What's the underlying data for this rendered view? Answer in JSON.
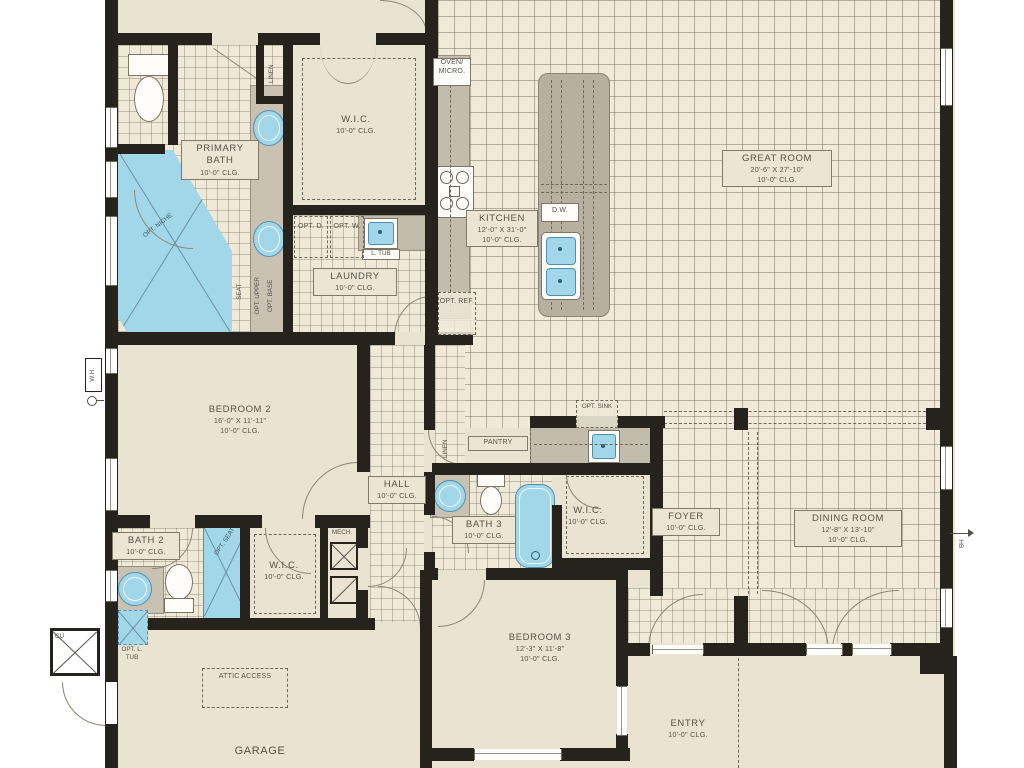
{
  "plan": {
    "rooms": {
      "primary_bath": {
        "name": "PRIMARY BATH",
        "clg": "10'-0\" CLG."
      },
      "wic_primary": {
        "name": "W.I.C.",
        "clg": "10'-0\" CLG."
      },
      "laundry": {
        "name": "LAUNDRY",
        "clg": "10'-0\" CLG."
      },
      "kitchen": {
        "name": "KITCHEN",
        "dims": "12'-0\" X 31'-0\"",
        "clg": "10'-0\" CLG."
      },
      "great_room": {
        "name": "GREAT ROOM",
        "dims": "20'-6\" X 27'-10\"",
        "clg": "10'-0\" CLG."
      },
      "bedroom2": {
        "name": "BEDROOM 2",
        "dims": "16'-0\" X 11'-11\"",
        "clg": "10'-0\" CLG."
      },
      "hall": {
        "name": "HALL",
        "clg": "10'-0\" CLG."
      },
      "bath2": {
        "name": "BATH 2",
        "clg": "10'-0\" CLG."
      },
      "wic_bedroom2": {
        "name": "W.I.C.",
        "clg": "10'-0\" CLG."
      },
      "bath3": {
        "name": "BATH 3",
        "clg": "10'-0\" CLG."
      },
      "wic_bedroom3": {
        "name": "W.I.C.",
        "clg": "10'-0\" CLG."
      },
      "foyer": {
        "name": "FOYER",
        "clg": "10'-0\" CLG."
      },
      "dining_room": {
        "name": "DINING ROOM",
        "dims": "12'-8\" X 13'-10\"",
        "clg": "10'-0\" CLG."
      },
      "bedroom3": {
        "name": "BEDROOM 3",
        "dims": "12'-3\" X 11'-8\"",
        "clg": "10'-0\" CLG."
      },
      "entry": {
        "name": "ENTRY",
        "clg": "10'-0\" CLG."
      },
      "garage": {
        "name": "GARAGE"
      }
    },
    "labels": {
      "linen": "LINEN",
      "pantry": "PANTRY",
      "opt_sink": "OPT. SINK",
      "mech": "MECH.",
      "oven_micro": "OVEN/ MICRO.",
      "opt_ref": "OPT. REF.",
      "dw": "D.W.",
      "opt_d": "OPT. D.",
      "opt_w": "OPT. W.",
      "l_tub": "L. TUB",
      "opt_upper": "OPT. UPPER",
      "opt_base": "OPT. BASE",
      "seat": "SEAT",
      "opt_niche": "OPT. NICHE",
      "opt_seat": "OPT. SEAT",
      "attic_access": "ATTIC ACCESS",
      "opt_l_tub": "OPT. L. TUB",
      "wh": "W.H.",
      "hb": "HB",
      "cu": "CU"
    },
    "colors": {
      "wall": "#26221c",
      "floor": "#eae3d2",
      "tile": "#f0e9d8",
      "fixture_blue": "#a2d6e9",
      "fixture_blue_dark": "#4e8fae",
      "counter_gray": "#c3bbac",
      "label_text": "#57514a"
    }
  }
}
